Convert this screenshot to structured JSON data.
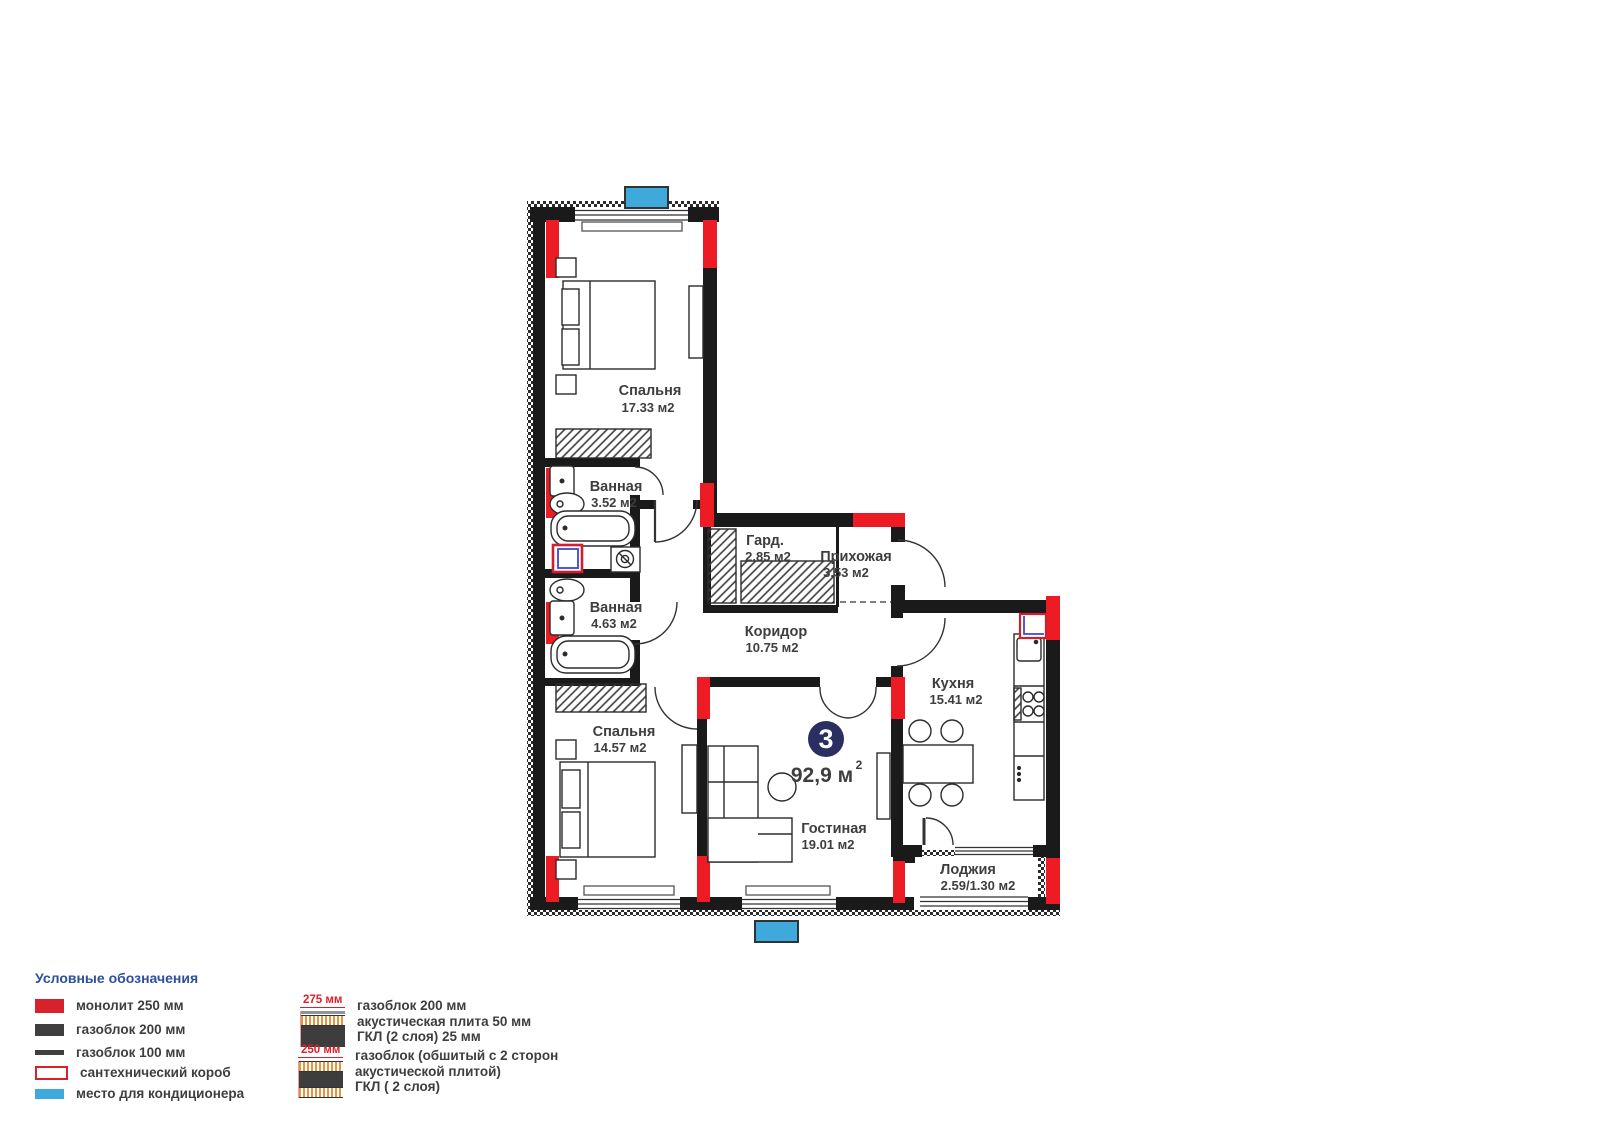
{
  "plan": {
    "badge": {
      "number": "3",
      "area_value": "92,9 м",
      "area_sup": "2"
    },
    "rooms": [
      {
        "name": "Спальня",
        "area": "17.33 м2"
      },
      {
        "name": "Ванная",
        "area": "3.52 м2"
      },
      {
        "name": "Ванная",
        "area": "4.63 м2"
      },
      {
        "name": "Спальня",
        "area": "14.57 м2"
      },
      {
        "name": "Гард.",
        "area": "2.85 м2"
      },
      {
        "name": "Прихожая",
        "area": "3.53 м2"
      },
      {
        "name": "Коридор",
        "area": "10.75 м2"
      },
      {
        "name": "Кухня",
        "area": "15.41 м2"
      },
      {
        "name": "Гостиная",
        "area": "19.01 м2"
      },
      {
        "name": "Лоджия",
        "area": "2.59/1.30 м2"
      }
    ]
  },
  "legend": {
    "title": "Условные обозначения",
    "items": [
      {
        "label": "монолит 250 мм",
        "swatch": "monolith-swatch"
      },
      {
        "label": "газоблок 200 мм",
        "swatch": "gasblock-200-swatch"
      },
      {
        "label": "газоблок 100 мм",
        "swatch": "gasblock-100-swatch"
      },
      {
        "label": "сантехнический короб",
        "swatch": "plumbing-box-swatch"
      },
      {
        "label": "место для кондиционера",
        "swatch": "ac-place-swatch"
      }
    ],
    "wall_sections": [
      {
        "thickness": "275 мм",
        "lines": [
          "газоблок 200 мм",
          "акустическая плита 50 мм",
          "ГКЛ (2 слоя) 25 мм"
        ]
      },
      {
        "thickness": "250 мм",
        "lines": [
          "газоблок (обшитый с 2 сторон",
          "акустической плитой)",
          "ГКЛ ( 2 слоя)"
        ]
      }
    ]
  },
  "colors": {
    "monolith_red": "#ed1c24",
    "wall_black": "#1a1a1a",
    "ac_blue": "#3fa9dc",
    "badge_navy": "#2a2e60",
    "legend_title_blue": "#2d4f9e",
    "text_gray": "#3e3e3e",
    "plumbing_outline_red": "#cf2030",
    "acoustic_orange": "#e8943e"
  }
}
